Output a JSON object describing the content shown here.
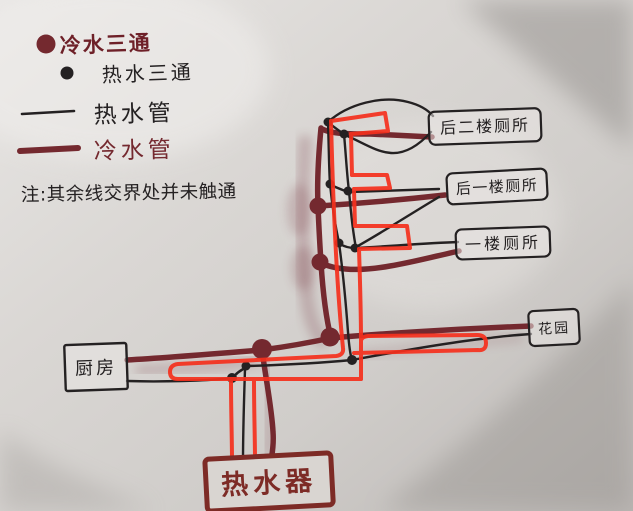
{
  "colors": {
    "cold": "#74292f",
    "hot": "#242122",
    "annotation": "#f5301d",
    "heater": "#7d2b26",
    "cold_text": "#6e2028",
    "paper": "#d7d4d1"
  },
  "legend": {
    "items": [
      {
        "label": "冷水三通",
        "symbol": "cold-tee-dot"
      },
      {
        "label": "热水三通",
        "symbol": "hot-tee-dot"
      },
      {
        "label": "热水管",
        "symbol": "hot-pipe-line"
      },
      {
        "label": "冷水管",
        "symbol": "cold-pipe-line"
      }
    ],
    "note": "注:其余线交界处并未触通"
  },
  "nodes": {
    "toilet_2f_rear": "后二楼厕所",
    "toilet_1f_rear": "后一楼厕所",
    "toilet_1f": "一楼厕所",
    "garden": "花园",
    "kitchen": "厨房",
    "heater": "热水器"
  }
}
